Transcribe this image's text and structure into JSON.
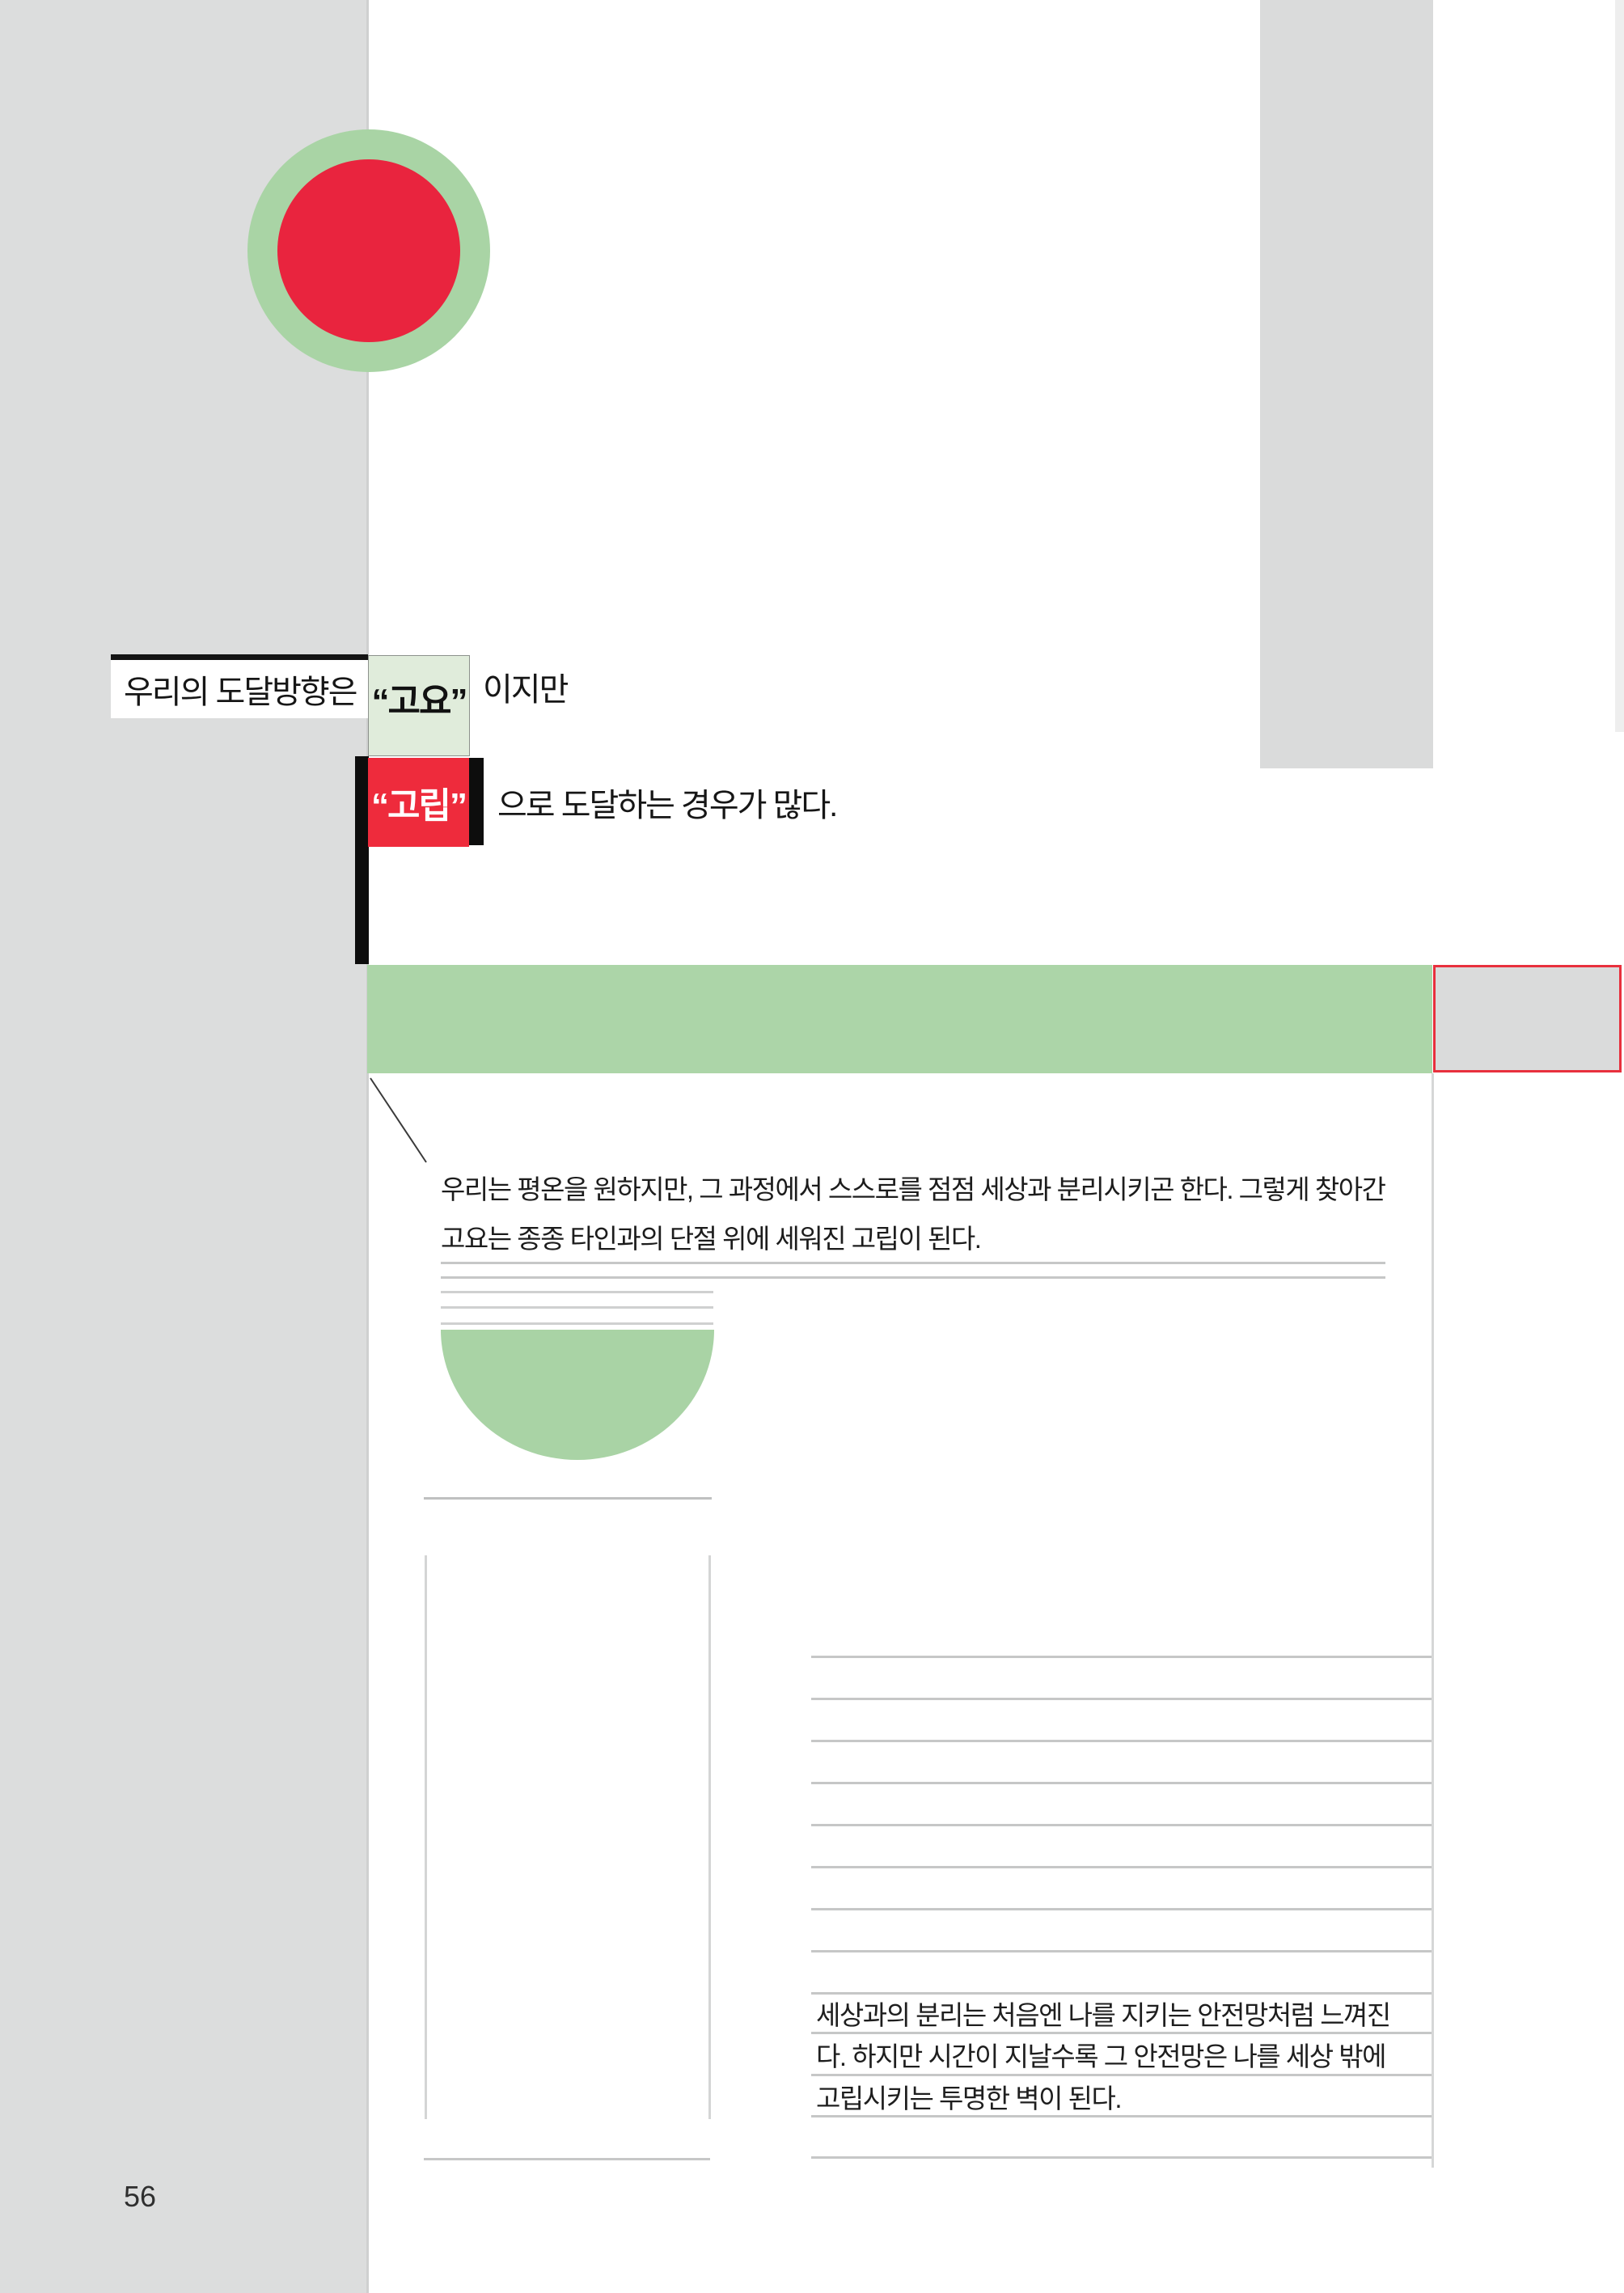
{
  "page": {
    "number": "56"
  },
  "headline": {
    "prefix": "우리의 도달방향은",
    "calm": "“고요”",
    "suffix": "이지만",
    "isolation": "“고립”",
    "line2_suffix": "으로 도달하는 경우가 많다."
  },
  "paragraph": "우리는 평온을 원하지만, 그 과정에서 스스로를 점점 세상과 분리시키곤 한다. 그렇게 찾아간 고요는 종종 타인과의 단절 위에 세워진 고립이 된다.",
  "note": {
    "lines": [
      "세상과의 분리는 처음엔 나를 지키는 안전망처럼 느껴진",
      "다. 하지만 시간이 지날수록 그 안전망은 나를 세상 밖에",
      "고립시키는 투명한 벽이 된다."
    ]
  },
  "colors": {
    "accent_red": "#e9243e",
    "accent_green": "#a9d4a5",
    "highlight_green": "#e0ecdb",
    "panel_gray": "#dcdddd",
    "rule_gray": "#c6c7c7",
    "black": "#141414"
  }
}
